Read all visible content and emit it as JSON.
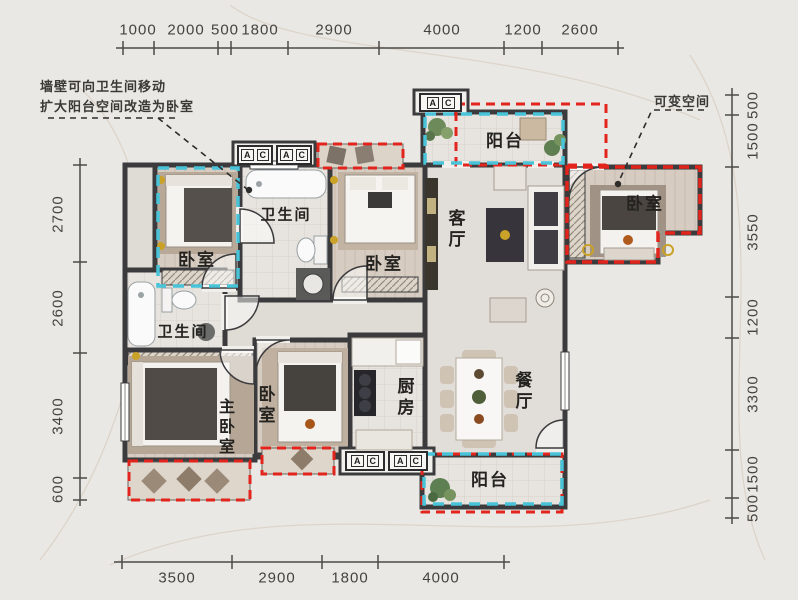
{
  "annotations": {
    "note_line1": "墙壁可向卫生间移动",
    "note_line2": "扩大阳台空间改造为卧室",
    "flexible_space_label": "可变空间",
    "ac": {
      "a": "A",
      "c": "C"
    }
  },
  "rooms": {
    "bedroom_top_left": "卧室",
    "bathroom_top": "卫生间",
    "bedroom_middle": "卧室",
    "living_room": "客厅",
    "balcony_top": "阳台",
    "bedroom_right": "卧室",
    "bathroom_lower": "卫生间",
    "master_bedroom": "主卧室",
    "bedroom_bottom": "卧室",
    "kitchen": "厨房",
    "dining_room": "餐厅",
    "balcony_bottom": "阳台"
  },
  "dimensions": {
    "top": [
      "1000",
      "2000",
      "500",
      "1800",
      "2900",
      "4000",
      "1200",
      "2600"
    ],
    "bottom": [
      "3500",
      "2900",
      "1800",
      "4000"
    ],
    "left": [
      "2700",
      "2600",
      "3400",
      "600"
    ],
    "right": [
      "500",
      "1500",
      "3550",
      "1200",
      "3300",
      "1500",
      "500"
    ]
  },
  "colors": {
    "highlight_red": "#e3241d",
    "highlight_cyan": "#49c3d8",
    "wall": "#3b3b3d",
    "background": "#eae8e4",
    "dimension_text": "#44433f"
  }
}
